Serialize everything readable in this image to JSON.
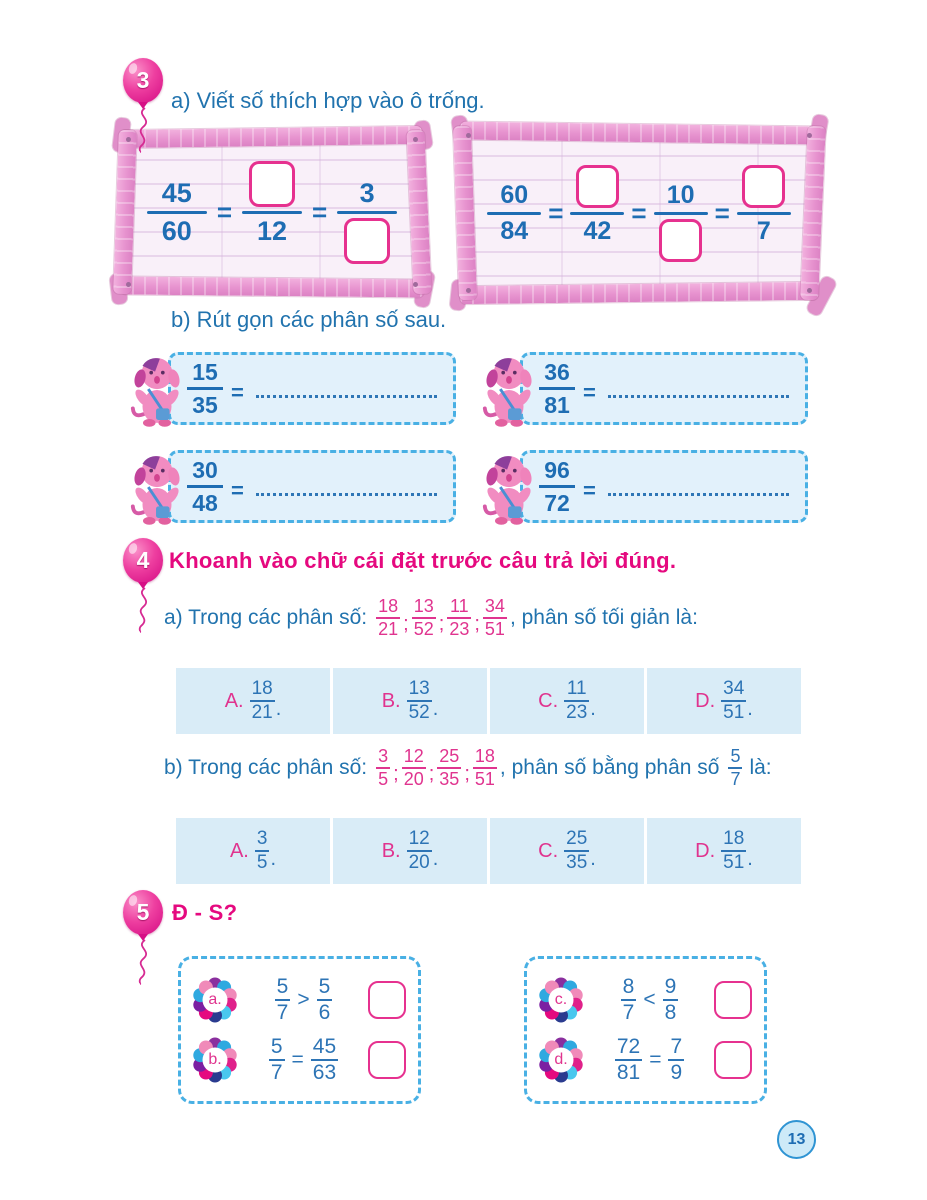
{
  "colors": {
    "text_blue": "#2173ae",
    "fraction_blue": "#1e6db3",
    "accent_pink": "#e5097f",
    "option_pink": "#e0348f",
    "option_cell_bg": "#d9ecf7",
    "dashed_border_blue": "#49b0e4",
    "frame_wood_pink": "#e793cf",
    "answer_box_border": "#e6318f"
  },
  "icons": {
    "badge": "balloon-icon",
    "mascot": "dog-mascot-icon",
    "label": "flower-label-icon"
  },
  "symbols": {
    "equals": "=",
    "semicolon": ";"
  },
  "page_number": "13",
  "ex3": {
    "badge": "3",
    "part_a_title": "a) Viết số thích hợp vào ô trống.",
    "frame1": {
      "given_n": "45",
      "given_d": "60",
      "step1_d": "12",
      "step2_n": "3"
    },
    "frame2": {
      "given_n": "60",
      "given_d": "84",
      "step1_d": "42",
      "step2_n": "10",
      "step3_d": "7"
    },
    "part_b_title": "b) Rút gọn các phân số sau.",
    "simplify": [
      {
        "n": "15",
        "d": "35"
      },
      {
        "n": "36",
        "d": "81"
      },
      {
        "n": "30",
        "d": "48"
      },
      {
        "n": "96",
        "d": "72"
      }
    ]
  },
  "ex4": {
    "badge": "4",
    "title": "Khoanh vào chữ cái đặt trước câu trả lời đúng.",
    "part_a": {
      "prefix": "a) Trong các phân số:",
      "fractions": [
        {
          "n": "18",
          "d": "21"
        },
        {
          "n": "13",
          "d": "52"
        },
        {
          "n": "11",
          "d": "23"
        },
        {
          "n": "34",
          "d": "51"
        }
      ],
      "suffix": ", phân số tối giản là:",
      "options": [
        {
          "label": "A.",
          "n": "18",
          "d": "21",
          "period": "."
        },
        {
          "label": "B.",
          "n": "13",
          "d": "52",
          "period": "."
        },
        {
          "label": "C.",
          "n": "11",
          "d": "23",
          "period": "."
        },
        {
          "label": "D.",
          "n": "34",
          "d": "51",
          "period": "."
        }
      ]
    },
    "part_b": {
      "prefix": "b) Trong các phân số:",
      "fractions": [
        {
          "n": "3",
          "d": "5"
        },
        {
          "n": "12",
          "d": "20"
        },
        {
          "n": "25",
          "d": "35"
        },
        {
          "n": "18",
          "d": "51"
        }
      ],
      "mid": ", phân số bằng phân số",
      "ref": {
        "n": "5",
        "d": "7"
      },
      "suffix": "là:",
      "options": [
        {
          "label": "A.",
          "n": "3",
          "d": "5",
          "period": "."
        },
        {
          "label": "B.",
          "n": "12",
          "d": "20",
          "period": "."
        },
        {
          "label": "C.",
          "n": "25",
          "d": "35",
          "period": "."
        },
        {
          "label": "D.",
          "n": "18",
          "d": "51",
          "period": "."
        }
      ]
    }
  },
  "ex5": {
    "badge": "5",
    "title": "Đ - S?",
    "groups": [
      {
        "items": [
          {
            "label": "a.",
            "ln": "5",
            "ld": "7",
            "op": ">",
            "rn": "5",
            "rd": "6"
          },
          {
            "label": "b.",
            "ln": "5",
            "ld": "7",
            "op": "=",
            "rn": "45",
            "rd": "63"
          }
        ]
      },
      {
        "items": [
          {
            "label": "c.",
            "ln": "8",
            "ld": "7",
            "op": "<",
            "rn": "9",
            "rd": "8"
          },
          {
            "label": "d.",
            "ln": "72",
            "ld": "81",
            "op": "=",
            "rn": "7",
            "rd": "9"
          }
        ]
      }
    ]
  }
}
